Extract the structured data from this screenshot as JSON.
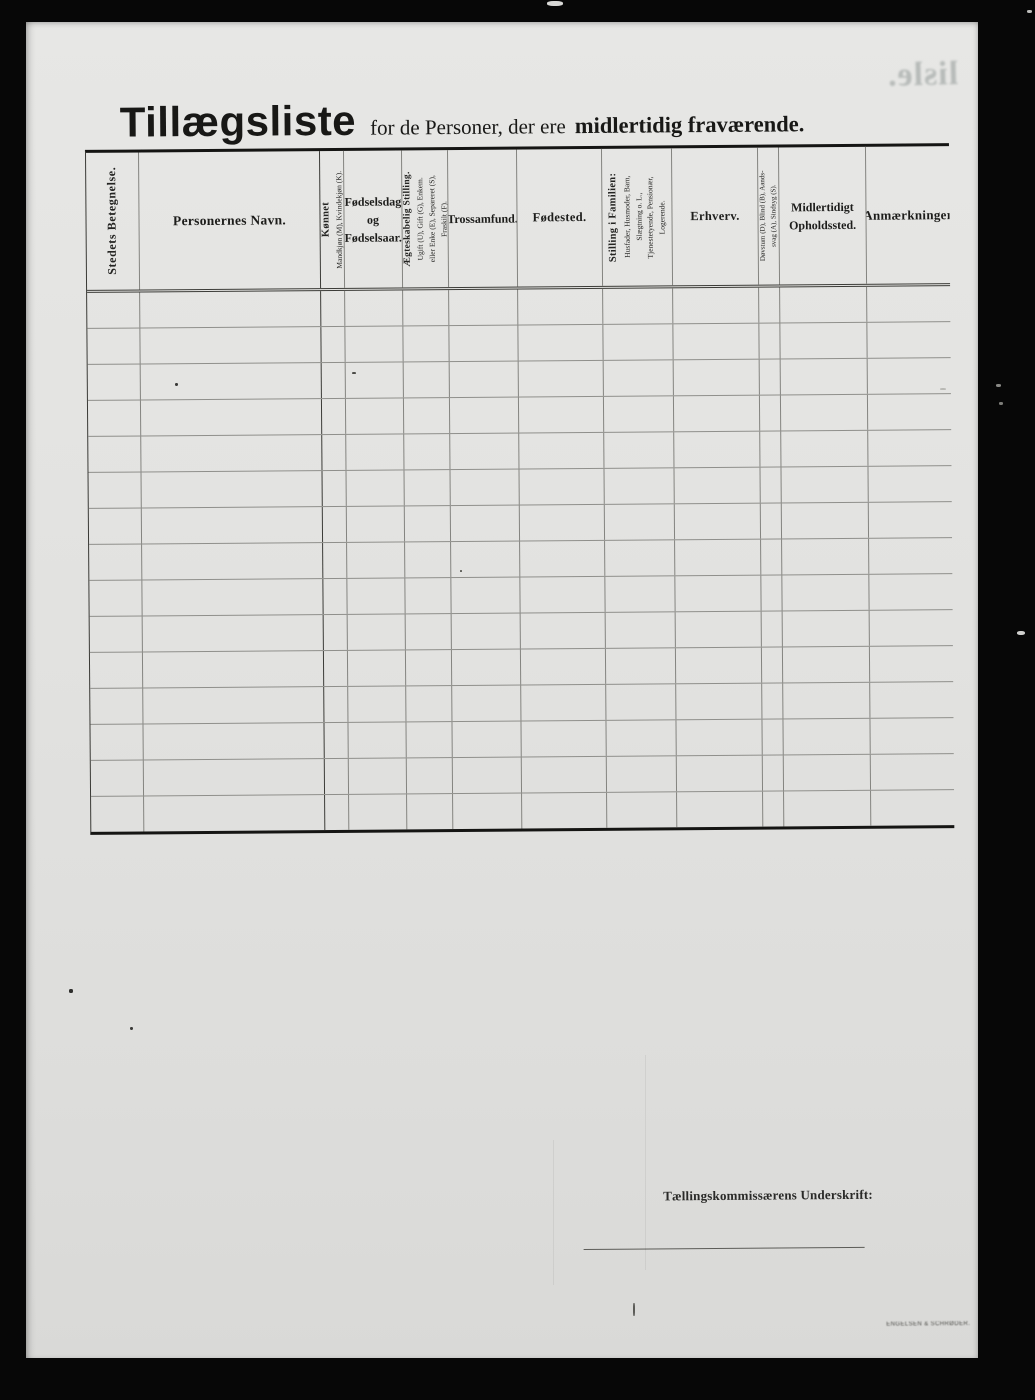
{
  "page": {
    "title_main": "Tillægsliste",
    "title_mid": "for de Personer, der ere",
    "title_bold": "midlertidig fraværende.",
    "ghost_text": "lisle.",
    "signature_label": "Tællingskommissærens Underskrift:",
    "printer_imprint": "ENGELSEN & SCHRØDER."
  },
  "table": {
    "row_count": 15,
    "columns": [
      {
        "id": "stedets-betegnelse",
        "orientation": "vertical",
        "lines": [
          "Stedets Betegnelse."
        ]
      },
      {
        "id": "personernes-navn",
        "orientation": "horizontal",
        "lines": [
          "Personernes Navn."
        ]
      },
      {
        "id": "konnet",
        "orientation": "vertical",
        "lines": [
          "Kønnet",
          "Mandkjøn (M), Kvindekjøn (K)."
        ]
      },
      {
        "id": "fodselsdag",
        "orientation": "horizontal",
        "lines": [
          "Fødselsdag",
          "og",
          "Fødselsaar."
        ]
      },
      {
        "id": "aegteskabelig-stilling",
        "orientation": "vertical",
        "lines": [
          "Ægteskabelig Stilling.",
          "Ugift (U), Gift (G), Enkem.",
          "eller Enke (E), Separeret (S),",
          "Fraskilt (F)."
        ]
      },
      {
        "id": "trossamfund",
        "orientation": "horizontal",
        "lines": [
          "Trossamfund."
        ]
      },
      {
        "id": "fodested",
        "orientation": "horizontal",
        "lines": [
          "Fødested."
        ]
      },
      {
        "id": "stilling-i-familien",
        "orientation": "vertical",
        "lines": [
          "Stilling i Familien:",
          "Husfader, Husmoder, Barn,",
          "Slægtning o. L.,",
          "Tjenestetyende, Pensionær,",
          "Logerende."
        ]
      },
      {
        "id": "erhverv",
        "orientation": "horizontal",
        "lines": [
          "Erhverv."
        ]
      },
      {
        "id": "dovstum",
        "orientation": "vertical",
        "lines": [
          "Døvstum (D), Blind (B), Aands-",
          "svag (A), Sindsyg (S)."
        ]
      },
      {
        "id": "midlertidigt-opholdssted",
        "orientation": "horizontal",
        "lines": [
          "Midlertidigt",
          "Opholdssted."
        ]
      },
      {
        "id": "anmaerkninger",
        "orientation": "horizontal",
        "lines": [
          "Anmærkninger"
        ]
      }
    ]
  },
  "artifacts": {
    "specks": [
      {
        "x": 175,
        "y": 383,
        "w": 3,
        "h": 3,
        "c": "#3a3a38"
      },
      {
        "x": 352,
        "y": 372,
        "w": 4,
        "h": 2,
        "c": "#4a4a46"
      },
      {
        "x": 460,
        "y": 570,
        "w": 2,
        "h": 2,
        "c": "#55554f"
      },
      {
        "x": 69,
        "y": 989,
        "w": 4,
        "h": 4,
        "c": "#2e2e2c"
      },
      {
        "x": 130,
        "y": 1027,
        "w": 3,
        "h": 3,
        "c": "#3a3a38"
      },
      {
        "x": 633,
        "y": 1303,
        "w": 1.5,
        "h": 13,
        "c": "#5a5a56"
      },
      {
        "x": 940,
        "y": 388,
        "w": 6,
        "h": 2,
        "c": "#b9b9b5"
      },
      {
        "x": 547,
        "y": 1,
        "w": 16,
        "h": 5,
        "c": "#d8d8d6"
      },
      {
        "x": 1017,
        "y": 631,
        "w": 8,
        "h": 4,
        "c": "#cfcfcd"
      },
      {
        "x": 1027,
        "y": 10,
        "w": 5,
        "h": 3,
        "c": "#bdbdbb"
      },
      {
        "x": 996,
        "y": 384,
        "w": 5,
        "h": 3,
        "c": "#8a8a86"
      },
      {
        "x": 999,
        "y": 402,
        "w": 4,
        "h": 3,
        "c": "#7d7d79"
      }
    ],
    "streaks": [
      {
        "x": 645,
        "y": 1055,
        "h": 215
      },
      {
        "x": 553,
        "y": 1140,
        "h": 145
      }
    ]
  }
}
